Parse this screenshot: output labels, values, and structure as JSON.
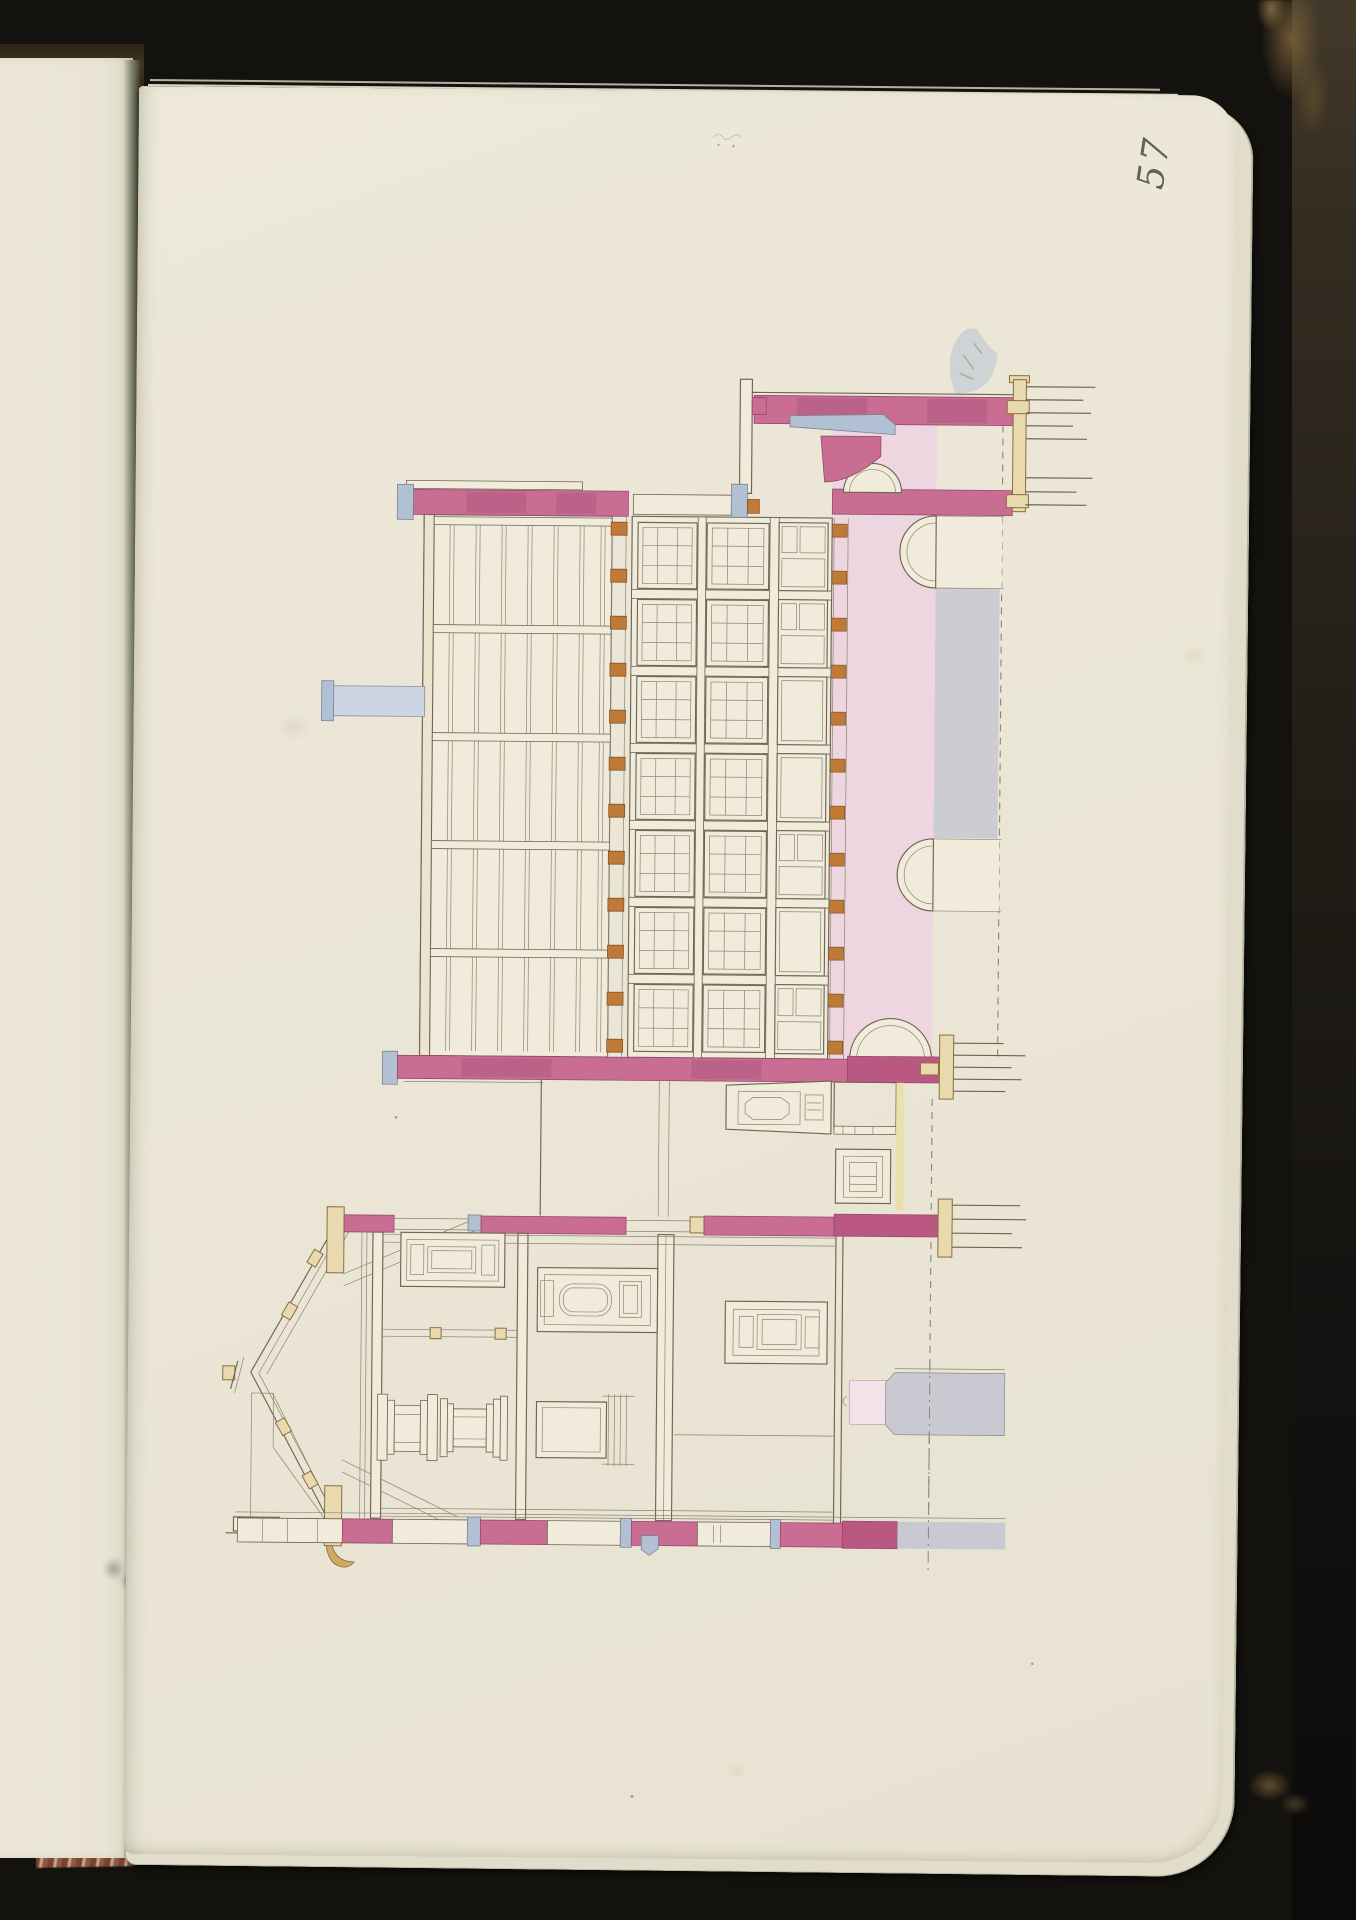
{
  "page": {
    "folio_number": "57"
  },
  "palette": {
    "cover": "#14120e",
    "cover_edge": "#3a3329",
    "paper": "#ebe6d7",
    "paper2": "#f0ebdb",
    "facing_paper": "#ece7d9",
    "under_paper": "#e2ddcb",
    "gutter": "#767b63",
    "endband_red": "#a54e3e",
    "endband_cream": "#d8c8ae",
    "marble_red": "#7c4034",
    "ink": "#6e6553",
    "ink2": "#8e8573",
    "ink3": "#8a8477",
    "crimson": "#ca6d92",
    "crimson2": "#96486e",
    "crimson3": "#ba5881",
    "pink": "#eed6e1",
    "pinkpale": "#f3e2ea",
    "orange": "#c07a38",
    "tan": "#e8d9ae",
    "tan2": "#8a6f3e",
    "tanfill": "#cfa963",
    "bluegray": "#b2c0d4",
    "bluegray2": "#ccd6e3",
    "gray": "#c9c9d1",
    "yellow": "#e9dfa2",
    "folio_ink": "#4e4a42"
  }
}
